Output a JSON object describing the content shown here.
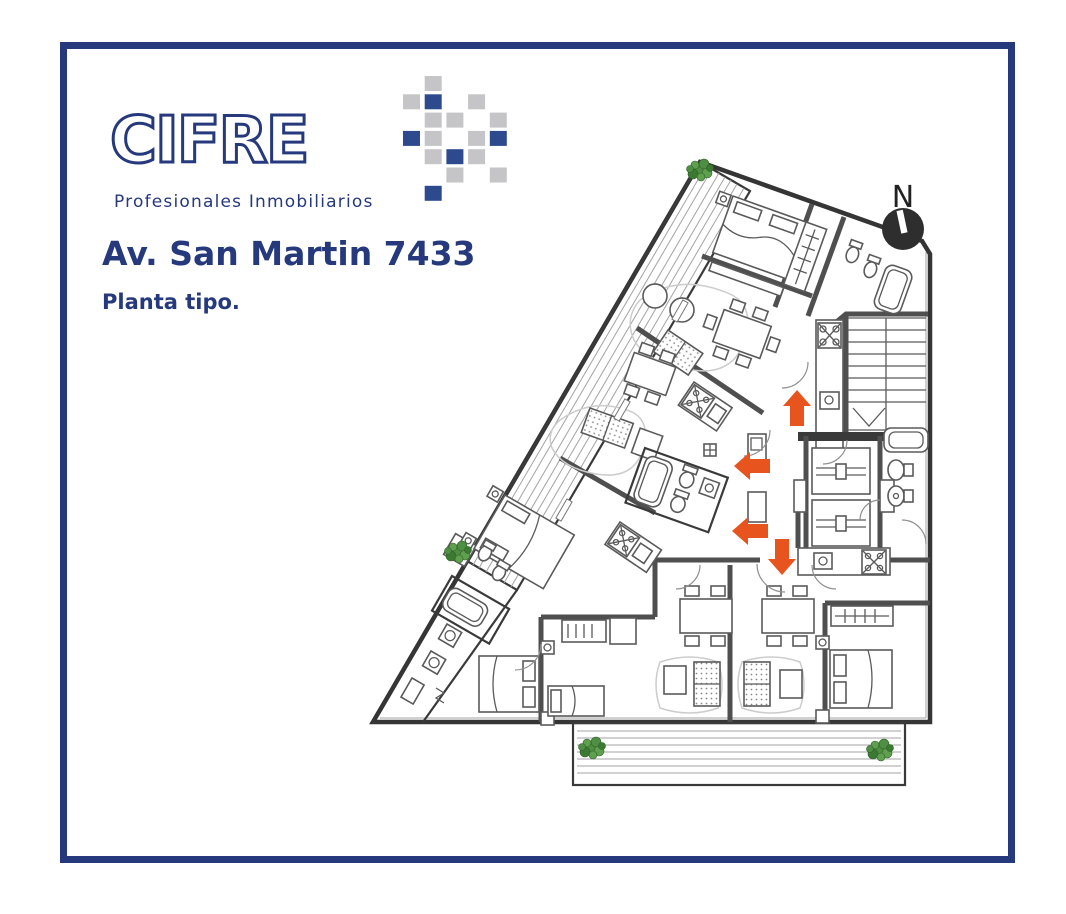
{
  "window": {
    "width": 1066,
    "height": 914,
    "background": "#ffffff"
  },
  "frame": {
    "border_color": "#25397c",
    "border_thickness_px": 7
  },
  "colors": {
    "navy": "#25397c",
    "mosaic_navy": "#2c4a8d",
    "mosaic_gray": "#c5c5c7",
    "arrow_orange": "#e8541e",
    "compass_dark": "#2e2e2e",
    "plan_line": "#3a3a3a",
    "plant_green": "#4e8f43"
  },
  "header": {
    "logo_text": "CIFRE",
    "tagline": "Profesionales Inmobiliarios",
    "title": "Av. San Martin 7433",
    "subtitle": "Planta tipo."
  },
  "logo_mosaic": {
    "cols": 5,
    "rows": 7,
    "cells": [
      {
        "col": 1,
        "row": 0,
        "tone": "gray"
      },
      {
        "col": 0,
        "row": 1,
        "tone": "gray"
      },
      {
        "col": 1,
        "row": 1,
        "tone": "navy"
      },
      {
        "col": 3,
        "row": 1,
        "tone": "gray"
      },
      {
        "col": 1,
        "row": 2,
        "tone": "gray"
      },
      {
        "col": 2,
        "row": 2,
        "tone": "gray"
      },
      {
        "col": 4,
        "row": 2,
        "tone": "gray"
      },
      {
        "col": 0,
        "row": 3,
        "tone": "navy"
      },
      {
        "col": 1,
        "row": 3,
        "tone": "gray"
      },
      {
        "col": 3,
        "row": 3,
        "tone": "gray"
      },
      {
        "col": 4,
        "row": 3,
        "tone": "navy"
      },
      {
        "col": 1,
        "row": 4,
        "tone": "gray"
      },
      {
        "col": 2,
        "row": 4,
        "tone": "navy"
      },
      {
        "col": 3,
        "row": 4,
        "tone": "gray"
      },
      {
        "col": 2,
        "row": 5,
        "tone": "gray"
      },
      {
        "col": 4,
        "row": 5,
        "tone": "gray"
      },
      {
        "col": 1,
        "row": 6,
        "tone": "navy"
      }
    ]
  },
  "compass": {
    "label": "N"
  },
  "floor_plan": {
    "type": "architectural-floor-plan",
    "entrance_arrows": [
      {
        "x": 797,
        "y": 409,
        "dir": "up"
      },
      {
        "x": 753,
        "y": 466,
        "dir": "left"
      },
      {
        "x": 751,
        "y": 531,
        "dir": "left"
      },
      {
        "x": 782,
        "y": 556,
        "dir": "down"
      }
    ],
    "plants": [
      {
        "x": 700,
        "y": 170
      },
      {
        "x": 458,
        "y": 552
      },
      {
        "x": 592,
        "y": 748
      },
      {
        "x": 880,
        "y": 750
      }
    ]
  }
}
